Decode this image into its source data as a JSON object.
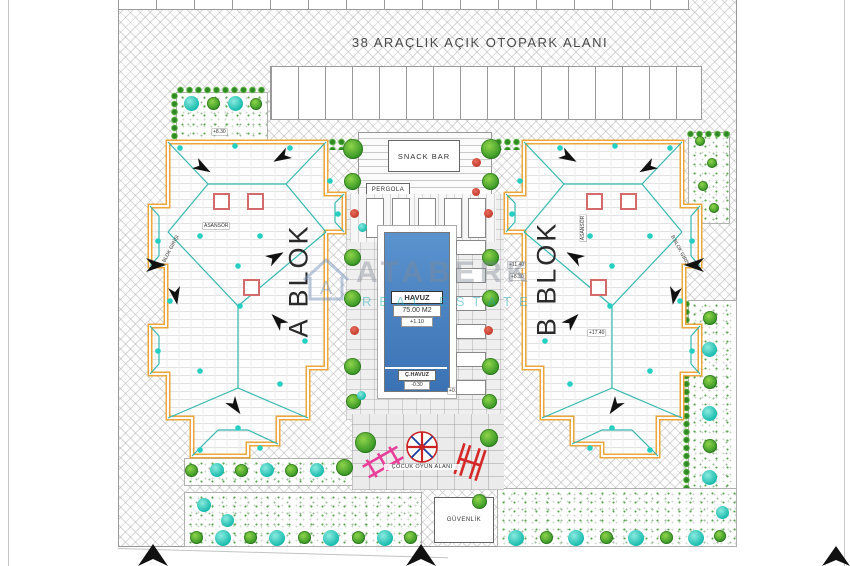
{
  "page": {
    "title": "38 ARAÇLIK AÇIK OTOPARK ALANI"
  },
  "blocks": {
    "a": {
      "label": "A BLOK",
      "entrance": "A BLOK GİRİŞİ"
    },
    "b": {
      "label": "B BLOK",
      "entrance": "B BLOK GİRİŞİ"
    }
  },
  "pool": {
    "label": "HAVUZ",
    "area": "75.00 M2",
    "elevation": "+1.10",
    "kids_label": "Ç.HAVUZ",
    "kids_elevation": "-0.30",
    "deck_elevation": "+0.30"
  },
  "amenities": {
    "snack_bar": "SNACK BAR",
    "pergola": "PERGOLA",
    "playground": "ÇOCUK OYUN ALANI",
    "security": "GÜVENLİK"
  },
  "annotations": {
    "elevator": "ASANSÖR",
    "lvl_830": "+8.30",
    "lvl_1140": "+11.40",
    "lvl_1740": "+17.40"
  },
  "watermark": {
    "monogram": "A",
    "brand": "ATABERK",
    "tagline": "REAL ESTATE"
  },
  "colors": {
    "pool_blue": "#3f7fc0",
    "outline_orange": "#eda63b",
    "ridge_teal": "#35b8b0",
    "tree_cyan": "#1fc9bd",
    "tree_green": "#46a52c",
    "flower_red": "#c0392b",
    "play_pink": "#e8409a",
    "play_red": "#d62828"
  }
}
